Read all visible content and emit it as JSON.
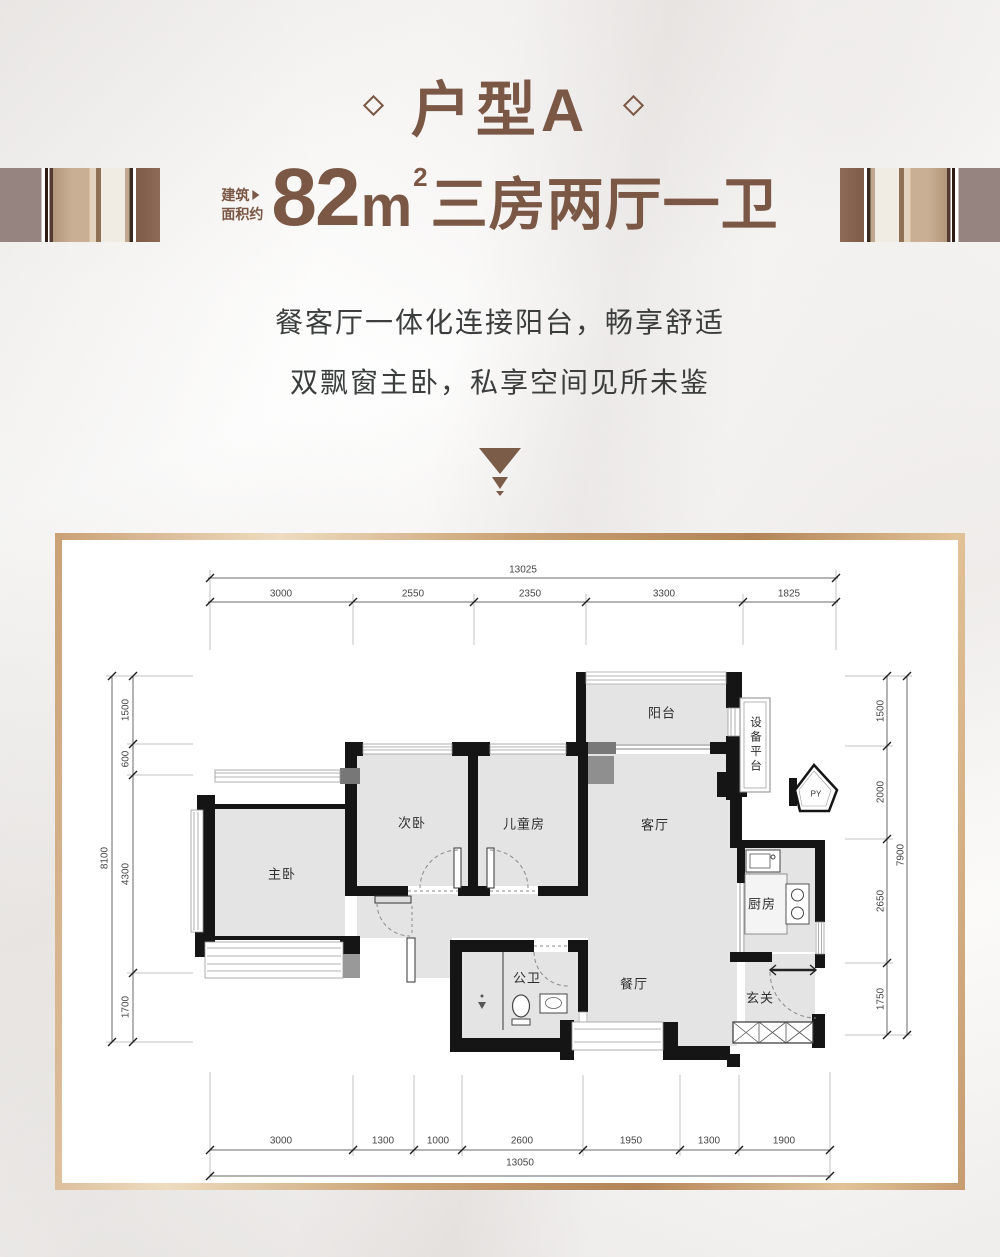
{
  "header": {
    "title": "户型A",
    "area_label_line1": "建筑",
    "area_label_line2": "面积约",
    "area_number": "82",
    "area_unit": "m",
    "area_exponent": "2",
    "area_layout": "三房两厅一卫",
    "tagline_line1": "餐客厅一体化连接阳台，畅享舒适",
    "tagline_line2": "双飘窗主卧，私享空间见所未鉴"
  },
  "colors": {
    "accent_brown": "#7b5846",
    "wall_black": "#151515",
    "room_fill": "#e4e4e4",
    "frame_bronze": "#c9a173",
    "tagline_gray": "#3c3e3e"
  },
  "floorplan": {
    "rooms": {
      "balcony": "阳台",
      "equipment_platform": "设备平台",
      "flue": "PY",
      "living_room": "客厅",
      "kitchen": "厨房",
      "dining_room": "餐厅",
      "entry": "玄关",
      "master_bedroom": "主卧",
      "second_bedroom": "次卧",
      "kids_room": "儿童房",
      "bathroom": "公卫"
    },
    "dimensions": {
      "top_total": "13025",
      "top_segments": [
        "3000",
        "2550",
        "2350",
        "3300",
        "1825"
      ],
      "bottom_segments": [
        "3000",
        "1300",
        "1000",
        "2600",
        "1950",
        "1300",
        "1900"
      ],
      "bottom_total": "13050",
      "left_segments": [
        "1500",
        "600",
        "4300",
        "1700"
      ],
      "left_total": "8100",
      "right_segments": [
        "1500",
        "2000",
        "2650",
        "1750"
      ],
      "right_total": "7900"
    }
  }
}
